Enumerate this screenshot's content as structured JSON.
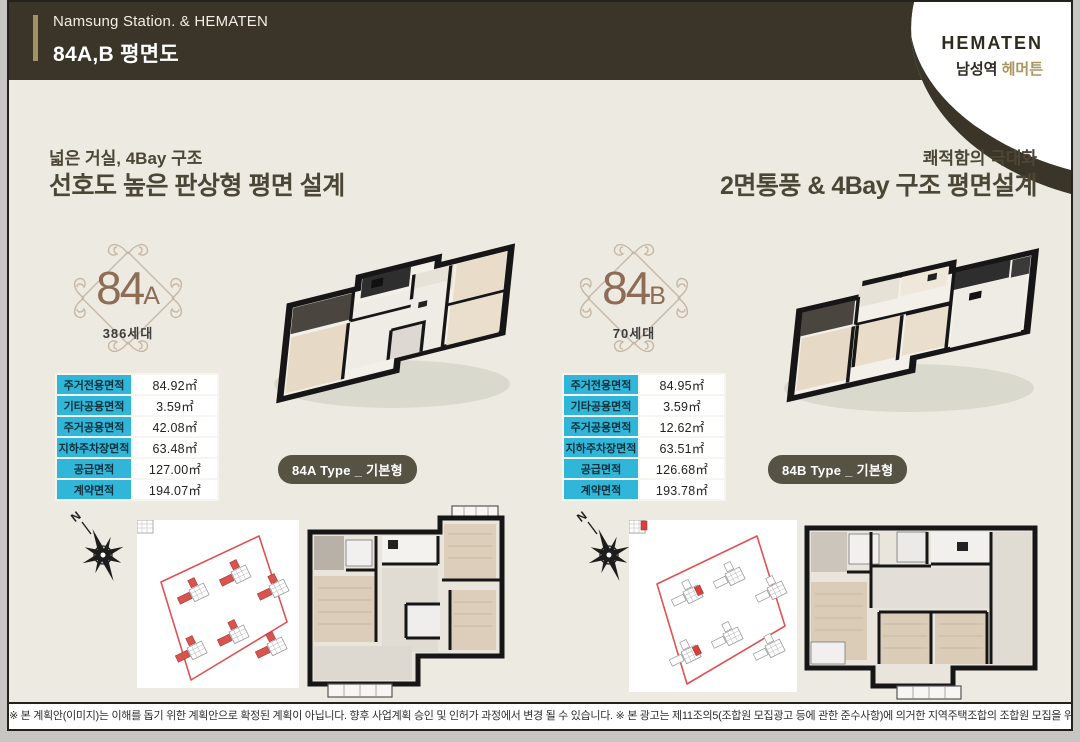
{
  "header": {
    "subtitle": "Namsung Station. & HEMATEN",
    "title": "84A,B 평면도",
    "logo_brand": "HEMATEN",
    "logo_name_prefix": "남성역 ",
    "logo_name_suffix": "헤머튼"
  },
  "units": [
    {
      "code": "84A",
      "tagline": "넓은 거실, 4Bay 구조",
      "headline": "선호도 높은 판상형 평면 설계",
      "badge_number": "84",
      "badge_letter": "A",
      "households": "386세대",
      "type_label": "84A Type _ 기본형",
      "areas": [
        {
          "label": "주거전용면적",
          "value": "84.92㎡"
        },
        {
          "label": "기타공용면적",
          "value": "3.59㎡"
        },
        {
          "label": "주거공용면적",
          "value": "42.08㎡"
        },
        {
          "label": "지하주차장면적",
          "value": "63.48㎡"
        },
        {
          "label": "공급면적",
          "value": "127.00㎡"
        },
        {
          "label": "계약면적",
          "value": "194.07㎡"
        }
      ]
    },
    {
      "code": "84B",
      "tagline": "쾌적함의 극대화",
      "headline": "2면통풍 & 4Bay 구조 평면설계",
      "badge_number": "84",
      "badge_letter": "B",
      "households": "70세대",
      "type_label": "84B Type _ 기본형",
      "areas": [
        {
          "label": "주거전용면적",
          "value": "84.95㎡"
        },
        {
          "label": "기타공용면적",
          "value": "3.59㎡"
        },
        {
          "label": "주거공용면적",
          "value": "12.62㎡"
        },
        {
          "label": "지하주차장면적",
          "value": "63.51㎡"
        },
        {
          "label": "공급면적",
          "value": "126.68㎡"
        },
        {
          "label": "계약면적",
          "value": "193.78㎡"
        }
      ]
    }
  ],
  "compass": {
    "label": "N"
  },
  "footer": {
    "disclaimer": "※ 본 계획안(이미지)는 이해를 돕기 위한 계획안으로 확정된 계획이 아닙니다. 향후 사업계획 승인 및 인허가 과정에서 변경 될 수 있습니다. ※ 본 광고는 제11조의5(조합원 모집광고 등에 관한 준수사항)에 의거한 지역주택조합의 조합원 모집을 위한 광고입니다."
  },
  "colors": {
    "header_dark": "#3a3528",
    "gold_accent": "#a39263",
    "cream_bg": "#edebe1",
    "table_cyan": "#2fb6d9",
    "badge_brown": "#8e6c55",
    "highlight_red": "#d9534f"
  }
}
